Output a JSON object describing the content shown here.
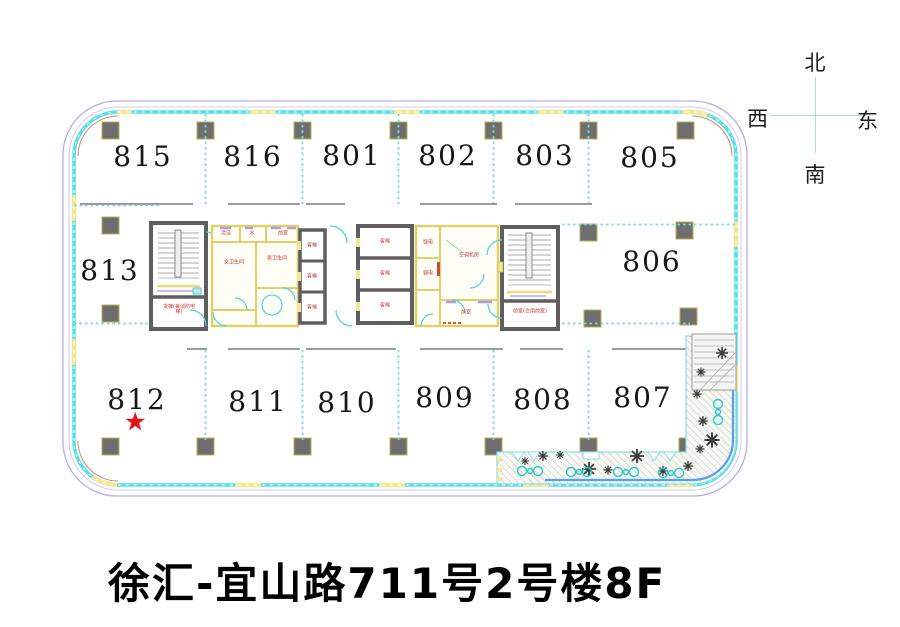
{
  "compass": {
    "north": "北",
    "west": "西",
    "east": "东",
    "south": "南"
  },
  "title": {
    "text": "徐汇-宜山路711号2号楼8F"
  },
  "rooms": [
    {
      "number": "815"
    },
    {
      "number": "816"
    },
    {
      "number": "801"
    },
    {
      "number": "802"
    },
    {
      "number": "803"
    },
    {
      "number": "805"
    },
    {
      "number": "813"
    },
    {
      "number": "806"
    },
    {
      "number": "812"
    },
    {
      "number": "811"
    },
    {
      "number": "810"
    },
    {
      "number": "809"
    },
    {
      "number": "808"
    },
    {
      "number": "807"
    }
  ],
  "marker": {
    "symbol": "★",
    "room": "812",
    "color": "#e8111a"
  },
  "core_labels": {
    "passenger_elevator": "客梯",
    "fire_elevator": "货梯(兼消防电梯)",
    "fire_lobby": "前室(合用前室)",
    "women_toilet": "女卫生间",
    "men_toilet": "男卫生间",
    "strong_power": "强电",
    "weak_power": "弱电",
    "ac_room": "空调机房",
    "lobby": "前室",
    "clean_room": "清洁",
    "water": "水"
  },
  "colors": {
    "outline_purple": "#b6ade8",
    "wall_cyan": "#56dfe6",
    "window_yellow": "#f1e895",
    "column_gray": "#6f6f6f",
    "core_wall_gray": "#5e5e5e",
    "partition_yellow": "#ddd26a",
    "door_cyan": "#54d2da",
    "accent_purple": "#b49ae0",
    "label_red": "#c43b3b",
    "star_red": "#e8111a",
    "compass_green": "#a9e7b6",
    "terrace_blue": "#57a0f0"
  }
}
